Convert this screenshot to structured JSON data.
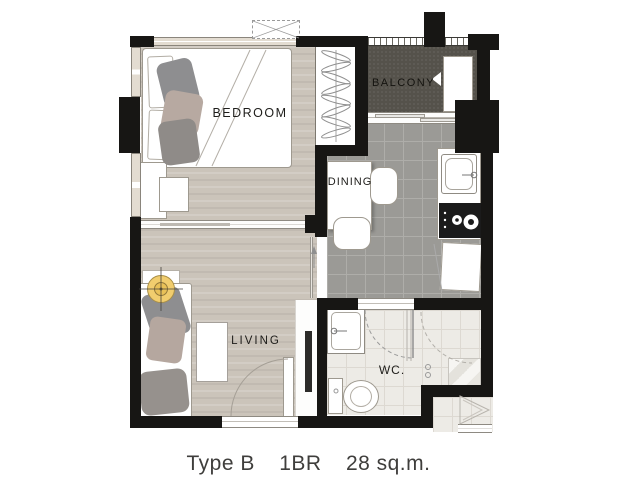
{
  "caption": {
    "type": "Type B",
    "bedrooms": "1BR",
    "area": "28 sq.m."
  },
  "rooms": {
    "bedroom": {
      "label": "BEDROOM"
    },
    "balcony": {
      "label": "BALCONY"
    },
    "dining": {
      "label": "DINING"
    },
    "living": {
      "label": "LIVING"
    },
    "wc": {
      "label": "WC."
    }
  },
  "furniture_icons": [
    "double-bed",
    "wardrobe-hangers",
    "washing-machine",
    "desk",
    "desk-chair",
    "dining-table",
    "dining-chair",
    "kitchen-sink",
    "stove-burners",
    "refrigerator",
    "sofa",
    "side-table",
    "floor-lamp",
    "tv",
    "bathroom-sink",
    "toilet",
    "shower",
    "entrance-door",
    "entry-door-triangle"
  ],
  "colors": {
    "wall": "#171614",
    "wood_floor": "#cbc4ba",
    "kitchen_tile": "#9b9a96",
    "wc_tile": "#edebe6",
    "balcony_floor": "#55524b",
    "lamp_accent": "#f1cd6e",
    "caption_text": "#3f3e3c"
  }
}
